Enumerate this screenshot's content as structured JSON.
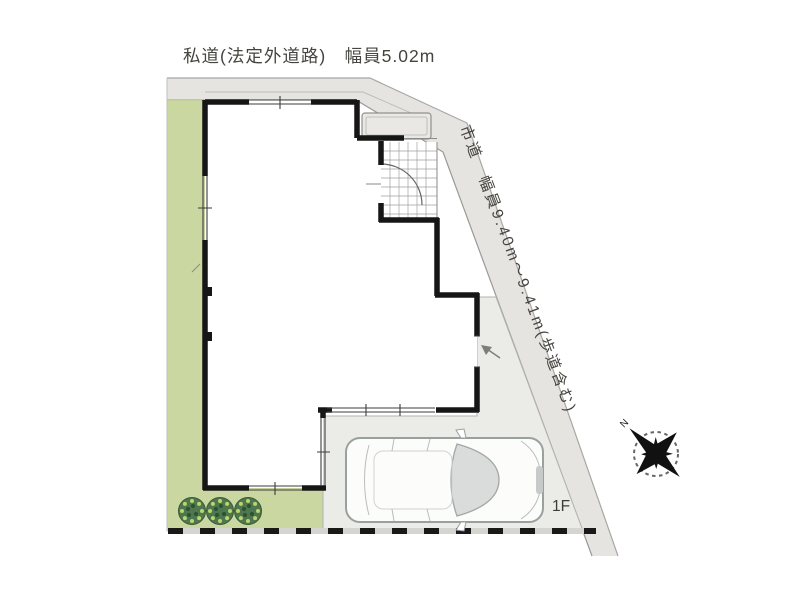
{
  "plan": {
    "labels": {
      "top_road": "私道(法定外道路)　幅員5.02m",
      "side_road": "市道　幅員9.40m～9.41m(歩道含む)",
      "floor": "1F",
      "compass_north": "N"
    },
    "colors": {
      "road_surface": "#e6e4e0",
      "garden_green": "#cbd7a1",
      "paving_grey": "#ebebe8",
      "wall_black": "#161616",
      "shrub_green": "#4e774d",
      "boundary_dash": "#191919"
    }
  }
}
